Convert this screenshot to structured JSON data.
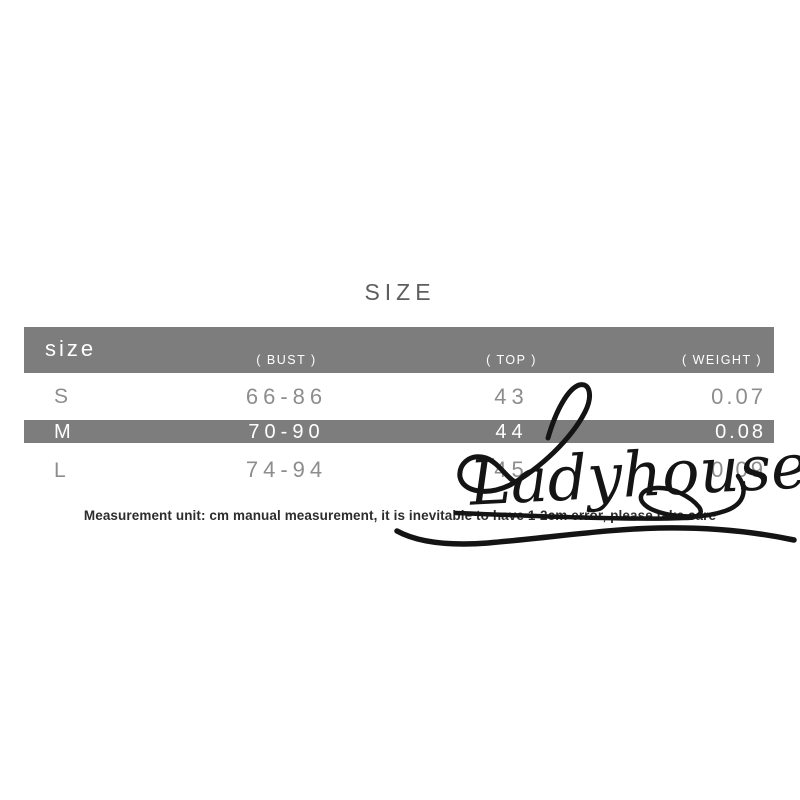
{
  "title": "SIZE",
  "table": {
    "band_color": "#7d7d7d",
    "body_text_color": "#8d8d8d",
    "header": {
      "size_label": "size",
      "columns": [
        "( BUST )",
        "( TOP )",
        "( WEIGHT )"
      ]
    },
    "rows": [
      {
        "size": "S",
        "bust": "66-86",
        "top": "43",
        "weight": "0.07",
        "highlighted": false
      },
      {
        "size": "M",
        "bust": "70-90",
        "top": "44",
        "weight": "0.08",
        "highlighted": true
      },
      {
        "size": "L",
        "bust": "74-94",
        "top": "45",
        "weight": "0.09",
        "highlighted": false
      }
    ]
  },
  "note": "Measurement unit: cm manual measurement, it is inevitable to have 1-2cm error, please take care",
  "watermark": {
    "text": "Ladyhouse",
    "color": "#141414"
  }
}
